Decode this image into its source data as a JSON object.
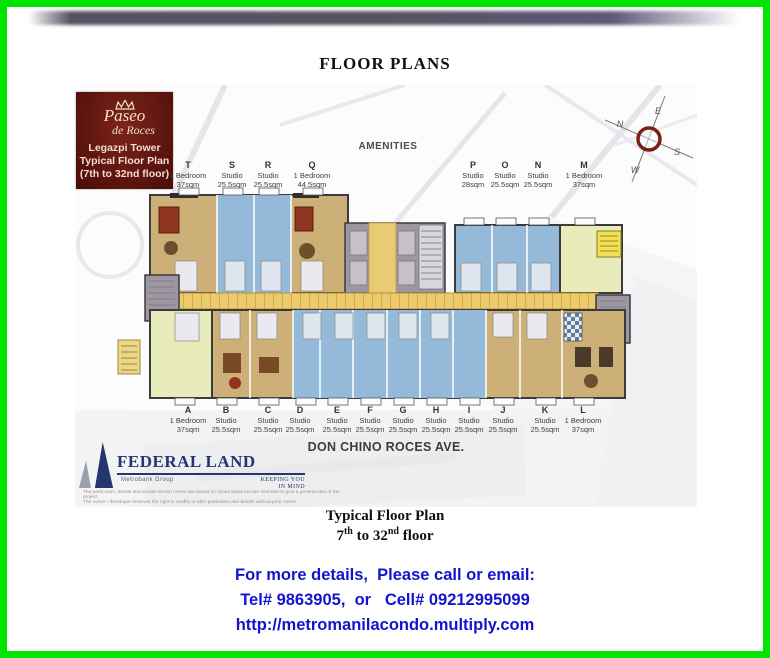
{
  "header": {
    "title": "FLOOR PLANS",
    "phone": "09212995099"
  },
  "logo_box": {
    "brand_script_1": "Paseo",
    "brand_script_2": "de Roces",
    "line1": "Legazpi Tower",
    "line2": "Typical Floor Plan",
    "line3": "(7th to 32nd floor)"
  },
  "plan": {
    "amenities_label": "AMENITIES",
    "street_label": "DON CHINO ROCES AVE.",
    "compass": {
      "n": "N",
      "e": "E",
      "s": "S",
      "w": "W"
    },
    "top_units": [
      {
        "id": "T",
        "type": "1 Bedroom",
        "area": "37sqm"
      },
      {
        "id": "S",
        "type": "Studio",
        "area": "25.5sqm"
      },
      {
        "id": "R",
        "type": "Studio",
        "area": "25.5sqm"
      },
      {
        "id": "Q",
        "type": "1 Bedroom",
        "area": "44.5sqm"
      },
      {
        "id": "P",
        "type": "Studio",
        "area": "28sqm"
      },
      {
        "id": "O",
        "type": "Studio",
        "area": "25.5sqm"
      },
      {
        "id": "N",
        "type": "Studio",
        "area": "25.5sqm"
      },
      {
        "id": "M",
        "type": "1 Bedroom",
        "area": "37sqm"
      }
    ],
    "bottom_units": [
      {
        "id": "A",
        "type": "1 Bedroom",
        "area": "37sqm"
      },
      {
        "id": "B",
        "type": "Studio",
        "area": "25.5sqm"
      },
      {
        "id": "C",
        "type": "Studio",
        "area": "25.5sqm"
      },
      {
        "id": "D",
        "type": "Studio",
        "area": "25.5sqm"
      },
      {
        "id": "E",
        "type": "Studio",
        "area": "25.5sqm"
      },
      {
        "id": "F",
        "type": "Studio",
        "area": "25.5sqm"
      },
      {
        "id": "G",
        "type": "Studio",
        "area": "25.5sqm"
      },
      {
        "id": "H",
        "type": "Studio",
        "area": "25.5sqm"
      },
      {
        "id": "I",
        "type": "Studio",
        "area": "25.5sqm"
      },
      {
        "id": "J",
        "type": "Studio",
        "area": "25.5sqm"
      },
      {
        "id": "K",
        "type": "Studio",
        "area": "25.5sqm"
      },
      {
        "id": "L",
        "type": "1 Bedroom",
        "area": "37sqm"
      }
    ]
  },
  "developer": {
    "name": "FEDERAL LAND",
    "group": "Metrobank Group",
    "tagline_line1": "KEEPING YOU",
    "tagline_line2": "IN MIND",
    "disclaimer_line1": "The particulars, details and visuals shown herein are based on actual plans but are intended to give a general idea of the project.",
    "disclaimer_line2": "The owner / developer reserves the right to modify or alter particulars and details without prior notice."
  },
  "caption": {
    "line1": "Typical Floor Plan",
    "floor_from": "7",
    "floor_from_sup": "th",
    "floor_mid": " to 32",
    "floor_to_sup": "nd",
    "floor_post": " floor"
  },
  "contact": {
    "line1": "For more details,  Please call or email:",
    "line2": "Tel# 9863905,  or   Cell# 09212995099",
    "line3": "http://metromanilacondo.multiply.com"
  },
  "colors": {
    "border_green": "#00e500",
    "phone_red": "#ee1111",
    "contact_blue": "#1414cf",
    "logo_maroon": "#5a130d",
    "unit_tan": "#cdb078",
    "unit_blue": "#95b9d8",
    "unit_green": "#e7ecba",
    "corridor_yellow": "#eccb6e",
    "core_gray": "#9d97a1"
  }
}
